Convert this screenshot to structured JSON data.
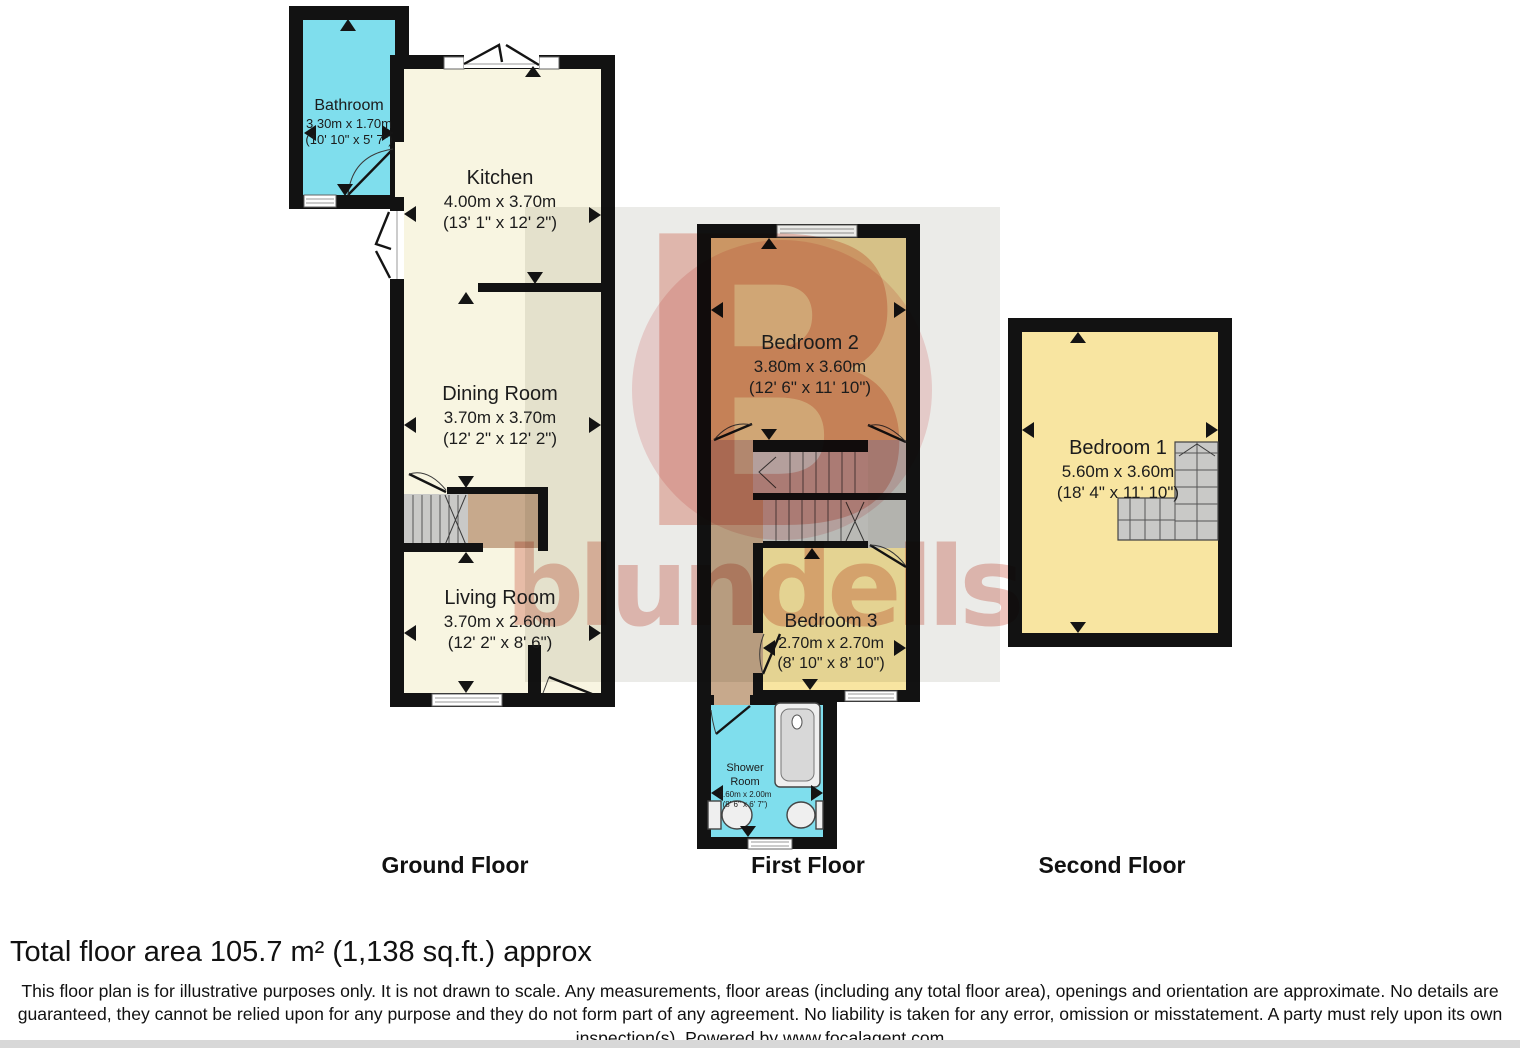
{
  "watermark": {
    "letter": "B",
    "text": "blundells"
  },
  "floors": [
    {
      "id": "ground",
      "label": "Ground Floor"
    },
    {
      "id": "first",
      "label": "First Floor"
    },
    {
      "id": "second",
      "label": "Second Floor"
    }
  ],
  "rooms": {
    "bathroom": {
      "name": "Bathroom",
      "metric": "3.30m x 1.70m",
      "imperial": "(10' 10\" x 5' 7\")"
    },
    "kitchen": {
      "name": "Kitchen",
      "metric": "4.00m x 3.70m",
      "imperial": "(13' 1\" x 12' 2\")"
    },
    "dining": {
      "name": "Dining Room",
      "metric": "3.70m x 3.70m",
      "imperial": "(12' 2\" x 12' 2\")"
    },
    "living": {
      "name": "Living Room",
      "metric": "3.70m x 2.60m",
      "imperial": "(12' 2\" x 8' 6\")"
    },
    "bedroom2": {
      "name": "Bedroom 2",
      "metric": "3.80m x 3.60m",
      "imperial": "(12' 6\" x 11' 10\")"
    },
    "bedroom3": {
      "name": "Bedroom 3",
      "metric": "2.70m x 2.70m",
      "imperial": "(8' 10\" x 8' 10\")"
    },
    "shower": {
      "name": "Shower Room",
      "metric": "2.60m x 2.00m",
      "imperial": "(8' 6\" x 6' 7\")"
    },
    "bedroom1": {
      "name": "Bedroom 1",
      "metric": "5.60m x 3.60m",
      "imperial": "(18' 4\" x 11' 10\")"
    }
  },
  "footer": {
    "total": "Total floor area 105.7 m² (1,138 sq.ft.) approx",
    "disclaimer": "This floor plan is for illustrative purposes only. It is not drawn to scale. Any measurements, floor areas (including any total floor area), openings and orientation are approximate. No details are guaranteed, they cannot be relied upon for any purpose and they do not form part of any agreement. No liability is taken for any error, omission or misstatement. A party must rely upon its own inspection(s). Powered by www.focalagent.com"
  },
  "colors": {
    "wall": "#121212",
    "wet": "#7fdeed",
    "cream": "#f8f5e1",
    "bed_tan": "#e9d294",
    "bed_yellow": "#f8e5a1",
    "hall_tan": "#c7a98c",
    "stair": "#c9c9c7",
    "landing": "#c2c2c0",
    "step_line": "#555555",
    "watermark_gray": "#ebebe8",
    "watermark_pink": "#f8dcdc",
    "watermark_red": "#eec4bd",
    "watermark_gold": "#f2c6bd"
  }
}
